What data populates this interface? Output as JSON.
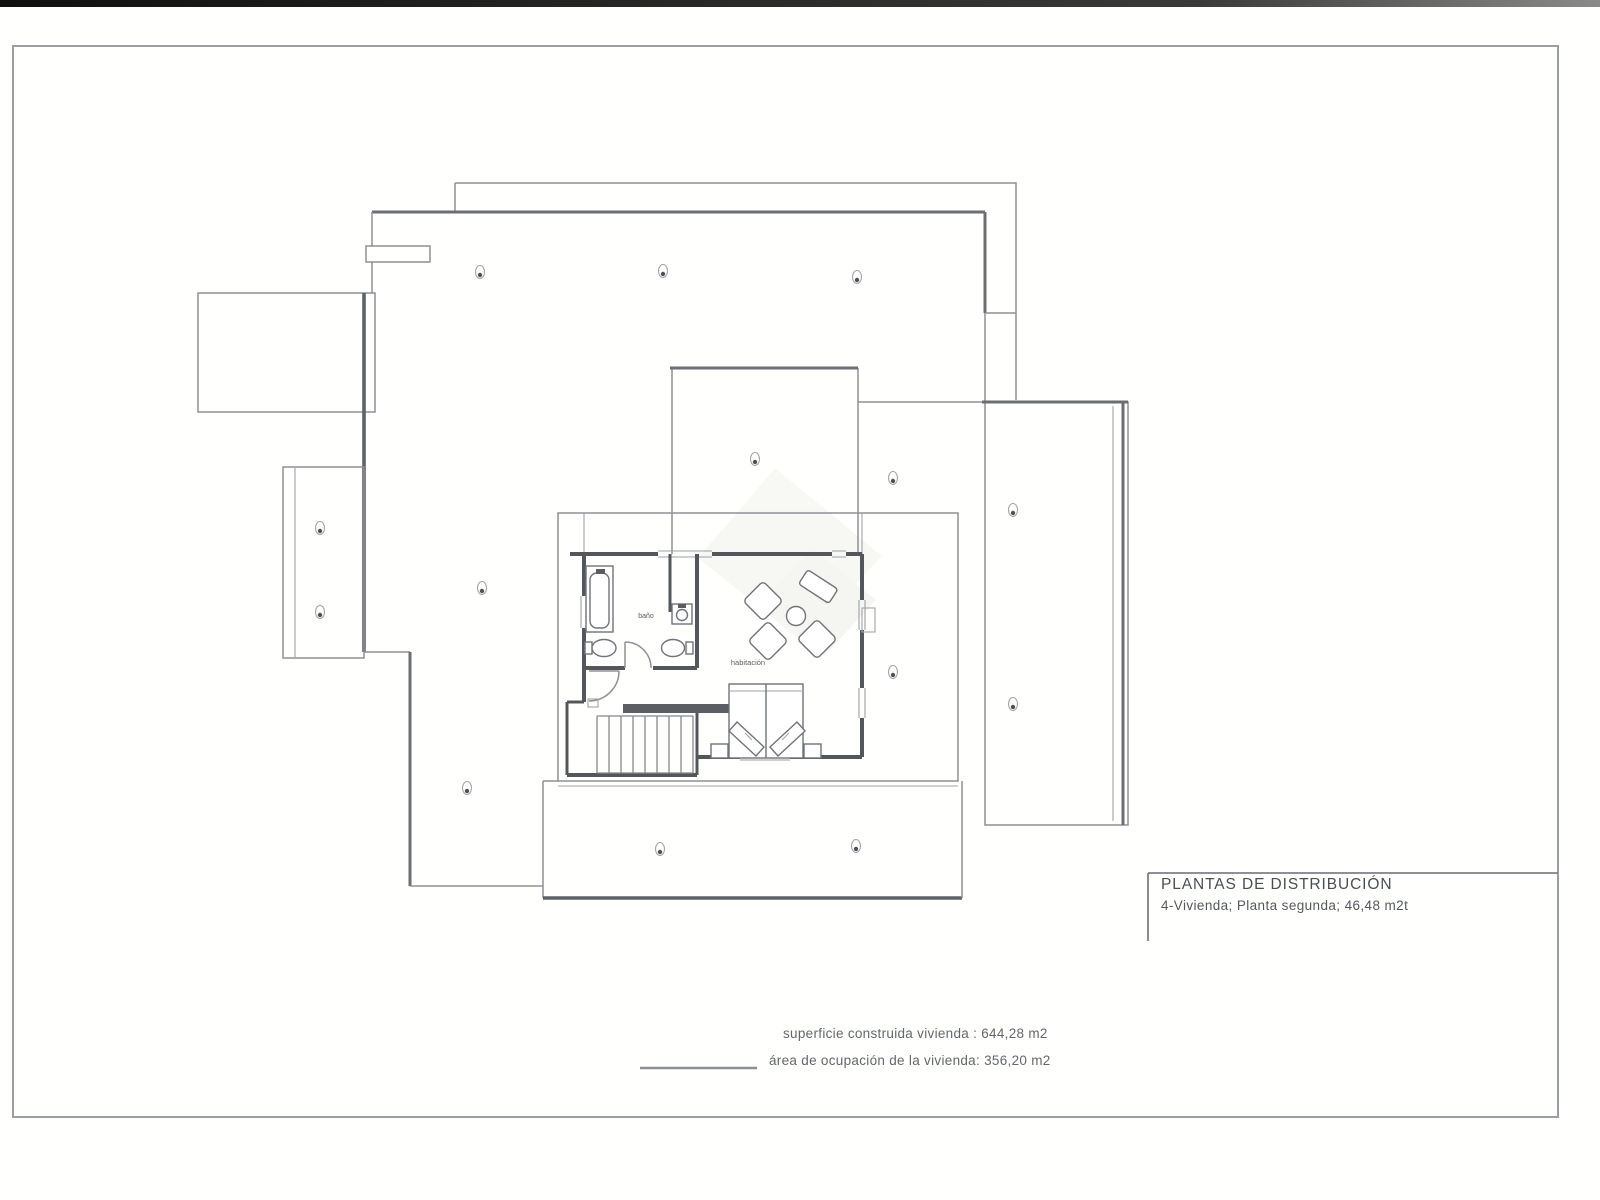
{
  "sheet": {
    "title_block": {
      "line1": "PLANTAS DE DISTRIBUCIÓN",
      "line2": "4-Vivienda; Planta segunda; 46,48 m2t"
    },
    "area_notes": {
      "built": "superficie construida vivienda : 644,28 m2",
      "occupied": "área de ocupación de la vivienda: 356,20 m2"
    },
    "room_labels": {
      "bathroom": "baño",
      "bedroom": "habitación"
    },
    "colors": {
      "outline": "#8e9093",
      "wall": "#53575c",
      "text": "#4d5154",
      "scan_bar": "#161616"
    }
  }
}
